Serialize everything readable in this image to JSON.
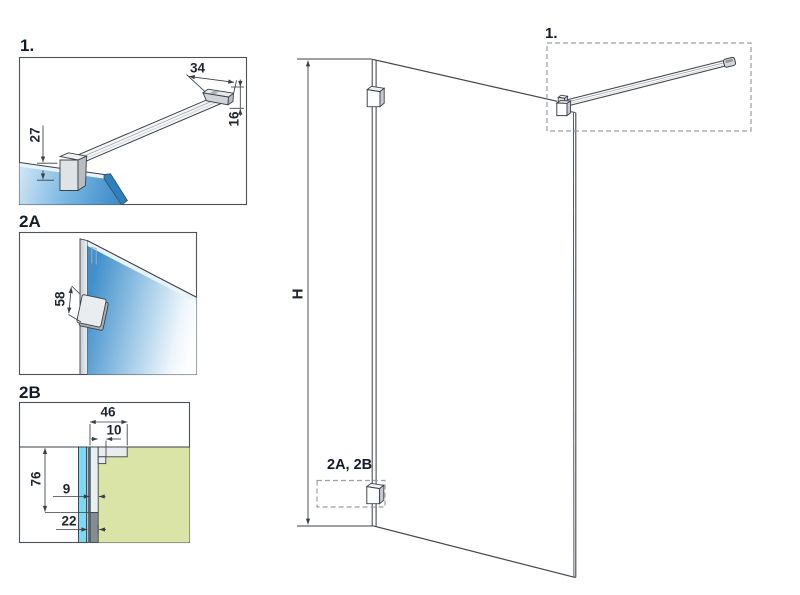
{
  "detail_1": {
    "label": "1.",
    "dim_top": "34",
    "dim_side": "16",
    "dim_left": "27"
  },
  "detail_2a": {
    "label": "2A",
    "dim_bracket": "58"
  },
  "detail_2b": {
    "label": "2B",
    "dim_width": "46",
    "dim_lip": "10",
    "dim_height": "76",
    "dim_profile": "9",
    "dim_total": "22"
  },
  "main_view": {
    "dim_height": "H",
    "callout_top": "1.",
    "callout_bottom": "2A, 2B"
  },
  "colors": {
    "line": "#3f444a",
    "dim_text": "#20262e",
    "label_text": "#131c28",
    "glass_blue": "#3787c6",
    "glass_cyan": "#7fd7f3",
    "wall_green": "#dae4a7",
    "profile_light": "#e9edef",
    "profile_dark": "#868d92",
    "dashed_box": "#9aa0a6"
  }
}
